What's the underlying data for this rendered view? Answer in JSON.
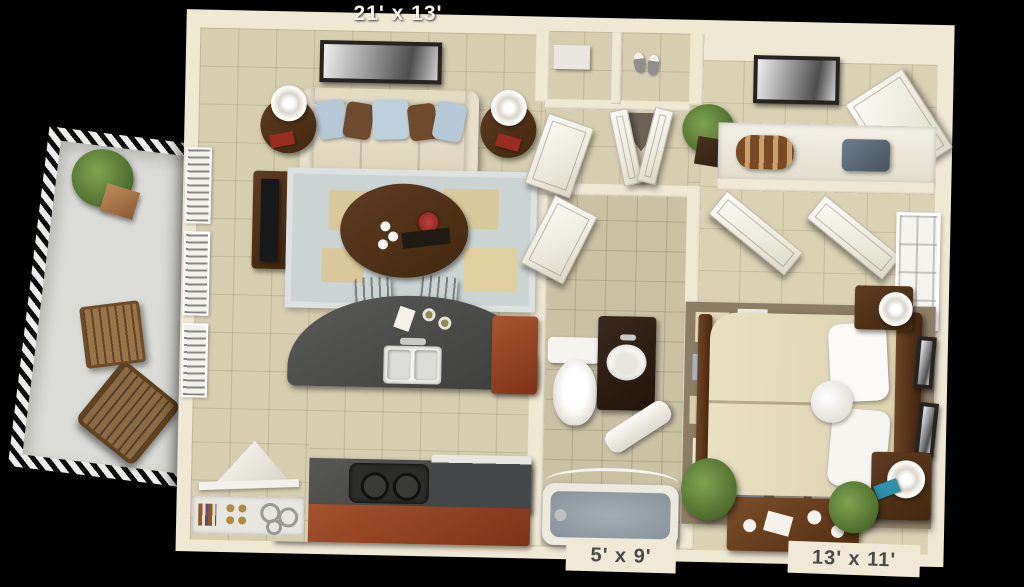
{
  "scene": {
    "type": "3d-apartment-floor-plan-render",
    "background_color": "#000000"
  },
  "dimension_labels": {
    "living_room": "21' x 13'",
    "bathroom": "5' x 9'",
    "bedroom": "13' x 11'"
  },
  "palette": {
    "background": "#000000",
    "wall_cream": "#efe8d3",
    "floor_tile": "#d7ceb1",
    "bathroom_floor": "#cbc2a6",
    "bedroom_floor": "#dbd2b5",
    "balcony_floor": "#dbdbd7",
    "counter_dark_gray": "#4d4d4b",
    "cabinet_cherry": "#9c4a2a",
    "dark_wood": "#55351f",
    "living_rug": "#ccd4d3",
    "rug_accent_tan": "#d9c89c",
    "bedroom_rug": "#8d7d66",
    "bedding_cream": "#e6ddc1",
    "pillow_blue": "#b6c9d8",
    "pillow_brown": "#6f4a2c",
    "plant_green": "#5d7f40",
    "tub_water": "#97a1a8",
    "label_light": "#f4f1e6",
    "label_dark": "#4a4a47"
  }
}
